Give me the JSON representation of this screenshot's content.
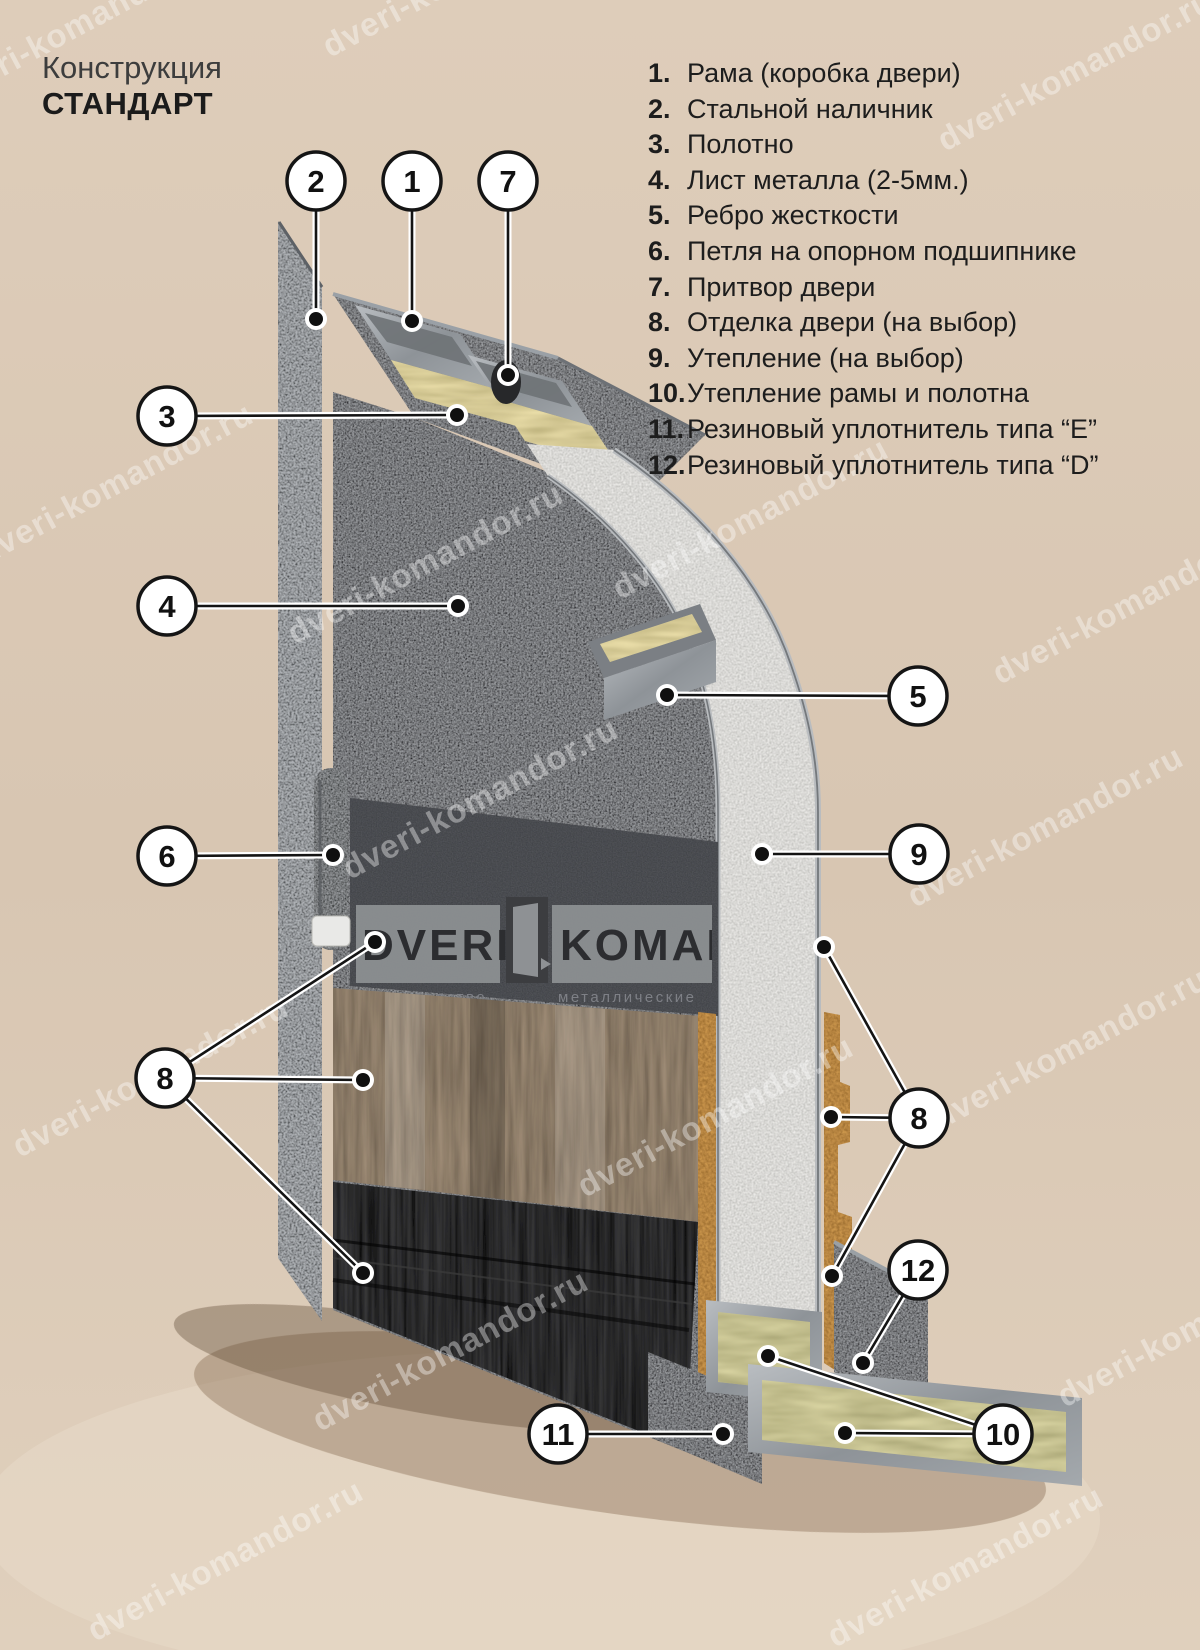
{
  "title": {
    "line1": "Конструкция",
    "line2": "СТАНДАРТ"
  },
  "legend": {
    "items": [
      {
        "number": "1.",
        "label": "Рама (коробка двери)"
      },
      {
        "number": "2.",
        "label": "Стальной наличник"
      },
      {
        "number": "3.",
        "label": "Полотно"
      },
      {
        "number": "4.",
        "label": "Лист металла (2-5мм.)"
      },
      {
        "number": "5.",
        "label": "Ребро жесткости"
      },
      {
        "number": "6.",
        "label": "Петля на опорном подшипнике"
      },
      {
        "number": "7.",
        "label": "Притвор двери"
      },
      {
        "number": "8.",
        "label": "Отделка двери (на выбор)"
      },
      {
        "number": "9.",
        "label": "Утепление (на выбор)"
      },
      {
        "number": "10.",
        "label": "Утепление рамы и полотна"
      },
      {
        "number": "11.",
        "label": "Резиновый уплотнитель типа “E”"
      },
      {
        "number": "12.",
        "label": "Резиновый уплотнитель типа “D”"
      }
    ]
  },
  "watermark": {
    "text": "dveri-komandor.ru"
  },
  "logo": {
    "word1": "DVERI",
    "word2": "KOMANDOR",
    "caption1": "производство",
    "caption2": "металлические"
  },
  "callouts": [
    {
      "number": "2"
    },
    {
      "number": "1"
    },
    {
      "number": "7"
    },
    {
      "number": "3"
    },
    {
      "number": "4"
    },
    {
      "number": "5"
    },
    {
      "number": "6"
    },
    {
      "number": "9"
    },
    {
      "number": "8"
    },
    {
      "number": "8"
    },
    {
      "number": "12"
    },
    {
      "number": "11"
    },
    {
      "number": "10"
    }
  ],
  "colors": {
    "background": "#dbc9b6",
    "text": "#1d1d1d",
    "callout_fill": "#ffffff",
    "callout_stroke": "#151515",
    "metal": "#9aa0a5",
    "insulation_wool": "#e9dda8",
    "cork": "#cf9a50",
    "foam": "#eeedea",
    "door_dark": "#2b2c2e"
  }
}
